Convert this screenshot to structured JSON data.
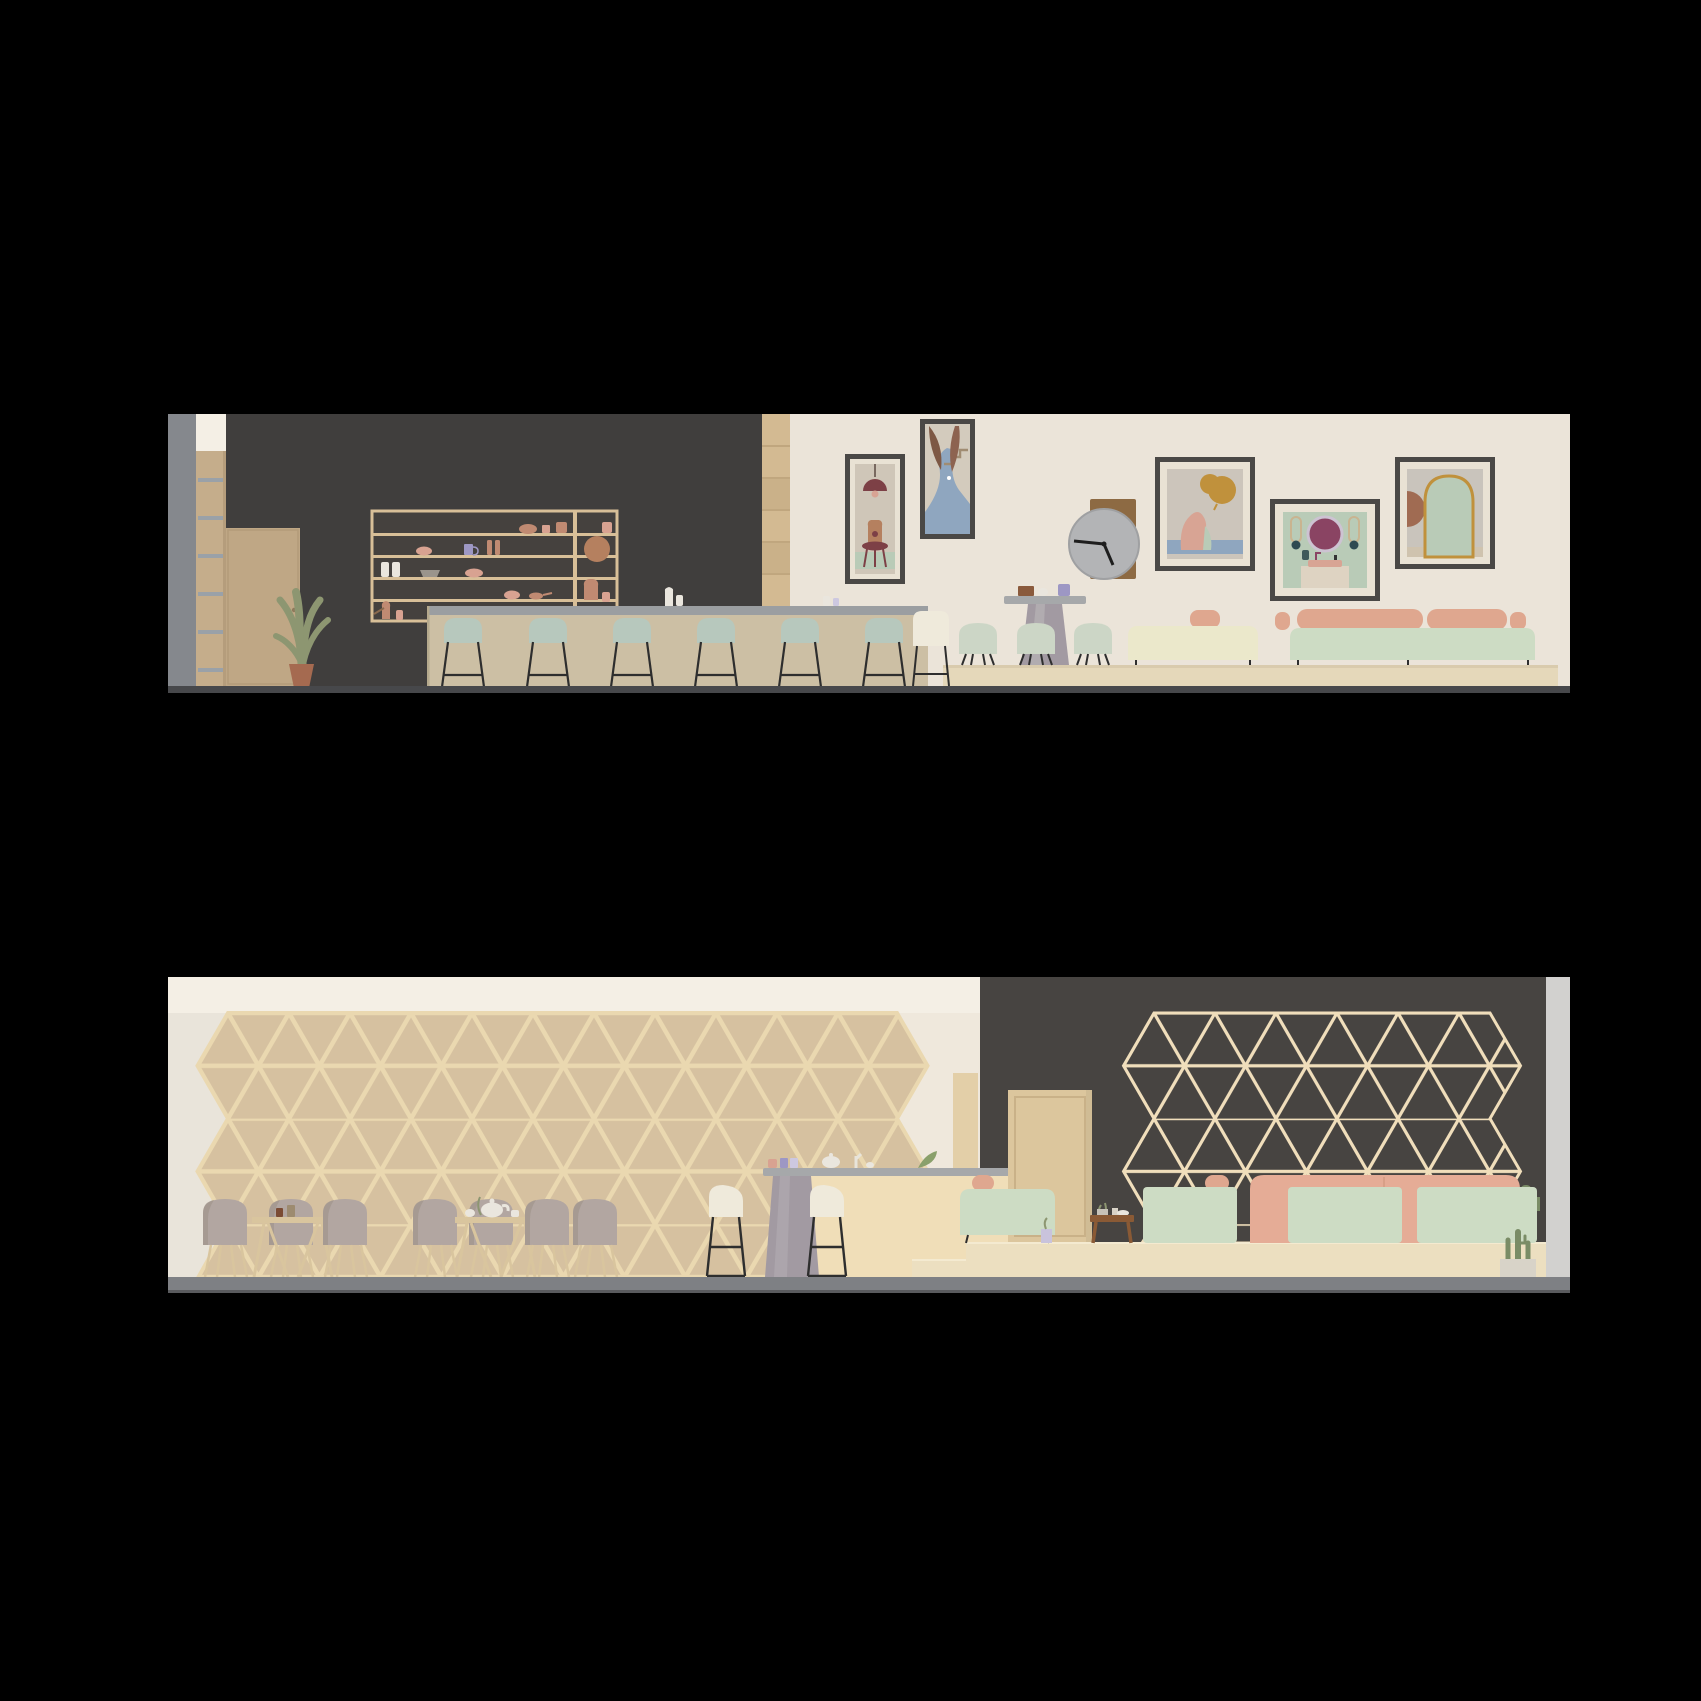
{
  "colors": {
    "canvas-bg": "#000000",
    "cream-wall": "#ebe4d9",
    "cream-wall-2": "#efe8dc",
    "cream-band": "#f4efe5",
    "charcoal-wall": "#403e3d",
    "charcoal-wall-2": "#474441",
    "concrete": "#85888d",
    "edge-strip": "#d2d1cf",
    "floor-dark": "#47484b",
    "floor-gray": "#7e8084",
    "wood-tan": "#c5ad8b",
    "wood-light": "#d8bf98",
    "door-tan": "#bfa785",
    "door-tan-2": "#dcc69d",
    "crate-tan": "#d3ba92",
    "shelf-interior": "#45413e",
    "shelf-steel": "#9aa1a8",
    "counter-body": "#ccbfa4",
    "counter-top": "#9b9ea1",
    "slab-gray": "#a6a8aa",
    "pedestal-gray": "#a29aa2",
    "counter-cream": "#f0deb8",
    "stool-mint": "#b7c8bd",
    "stool-cream": "#efeadb",
    "shell-mint": "#ccd6c6",
    "leg-black": "#2e2e2e",
    "bench-cream": "#ebe8cb",
    "sofa-mint": "#cddcc4",
    "cushion-pink": "#dfa78f",
    "sofa-pink": "#e5ac96",
    "platform": "#e5d8ba",
    "platform-2": "#ecdfc0",
    "plant-green": "#8d9671",
    "cactus-green": "#7a8c66",
    "pot-terracotta": "#a56a50",
    "lattice-wood": "#ead8b0",
    "lattice-fill": "#d6c1a0",
    "lattice-line-2": "#f0debb",
    "frame-dark": "#4a4846",
    "mat-white": "#e9e2d4",
    "art-beige": "#cfc6b8",
    "art-gray": "#c9c4bc",
    "art-maroon": "#7d4046",
    "art-terracotta": "#b5805f",
    "art-blue": "#8fa6bf",
    "art-mint": "#b9cbb7",
    "art-ochre": "#c0913c",
    "art-pink": "#d8a494",
    "art-plum": "#8a4463",
    "clock-face": "#b3b4b6",
    "clock-board": "#8d6a43",
    "chair-taupe": "#b2a6a1",
    "table-wood": "#d9c59e",
    "ceramic-terracotta": "#c08a72",
    "ceramic-pink": "#d8a291",
    "ceramic-white": "#eae6de",
    "ceramic-purple": "#9d97c4",
    "side-table-wood": "#8a5a35"
  },
  "scene": {
    "type": "architectural interior elevation renderings, cafe fit-out",
    "background": "black margins, two horizontal panels",
    "panels": [
      {
        "name": "upper elevation - bar and gallery wall",
        "walls": [
          "grey concrete pilaster (far left)",
          "charcoal feature wall (left)",
          "cream gallery wall (right)"
        ],
        "fixtures": {
          "ladder_shelf_column": 1,
          "storage_door": 1,
          "potted_plant": 1,
          "wall_shelf_with_ceramics": 1,
          "ceramic_pieces_on_shelf": 18,
          "crate_stack_column": 1,
          "bar_counter": 1,
          "mint_bar_stools": 6,
          "white_high_chair": 1,
          "pedestal_table": 1,
          "mint_shell_chairs": 3,
          "cream_bench": 1,
          "mint_sofa": 1,
          "pink_back_cushions": 5,
          "framed_artworks": 5,
          "wall_clock": 1,
          "seating_platform": 1
        },
        "artworks": [
          "maroon pendant lamp over stool with terracotta vase, mint floor band",
          "abstract river landscape with stairs and two brown leaves",
          "kneeling pink figure with ochre balloon above blue water",
          "round plum mirror over vanity basin on mint ground",
          "large mint arch with ochre edges and brown half-disc"
        ],
        "clock_hands": "long hand pointing left, short hand pointing lower-right"
      },
      {
        "name": "lower elevation - triangular shelf wall and lounge",
        "walls": [
          "cream wall (left)",
          "charcoal feature wall (right)",
          "pale grey edge pier (far right)"
        ],
        "fixtures": {
          "triangular_plywood_shelf_grid": {
            "rows": 5,
            "style": "filled plywood modules"
          },
          "triangular_open_grid_on_dark_wall": {
            "rows": 4,
            "style": "open timber frame"
          },
          "dining_chairs": 7,
          "trestle_tables": 2,
          "teapot_and_cups": 1,
          "counter_slab_with_pedestal": 1,
          "cream_bar_stools": 2,
          "tan_door": 1,
          "raised_platform_with_steps": 1,
          "walnut_side_table": 1,
          "mint_lounge_bench": 1,
          "mint_banquette_backs": 3,
          "pink_sofa": 1,
          "cacti_planters": 2
        }
      }
    ]
  }
}
